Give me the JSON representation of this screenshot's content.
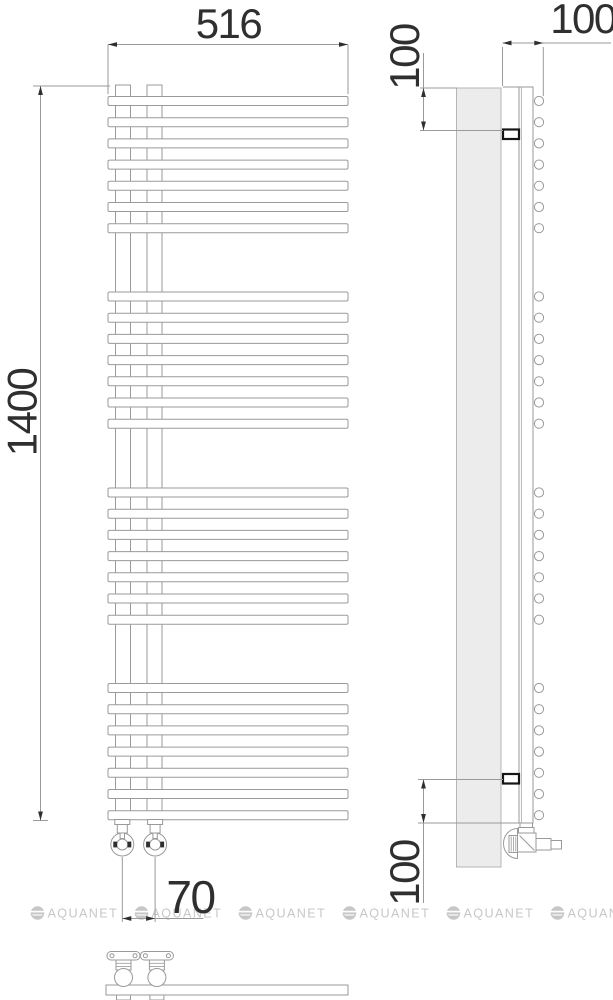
{
  "dimensions": {
    "width_label": "516",
    "height_label": "1400",
    "valve_spacing_label": "70",
    "wall_depth_label": "100",
    "top_bracket_offset_label": "100",
    "bottom_bracket_offset_label": "100"
  },
  "watermark": {
    "text": "AQUANET",
    "repeat_count": 6
  },
  "drawing": {
    "type": "towel-radiator-technical-drawing",
    "structure": {
      "bar_groups": 4,
      "bars_per_group": 7,
      "total_bars": 28,
      "collectors": 2,
      "wall_brackets": 2,
      "valves": 2
    },
    "colors": {
      "line": "#9a9a9a",
      "soft": "#b5b5b5",
      "dark": "#2f2f2f",
      "panel_fill": "#ececec",
      "watermark": "#c7c7c7",
      "white": "#ffffff"
    }
  }
}
